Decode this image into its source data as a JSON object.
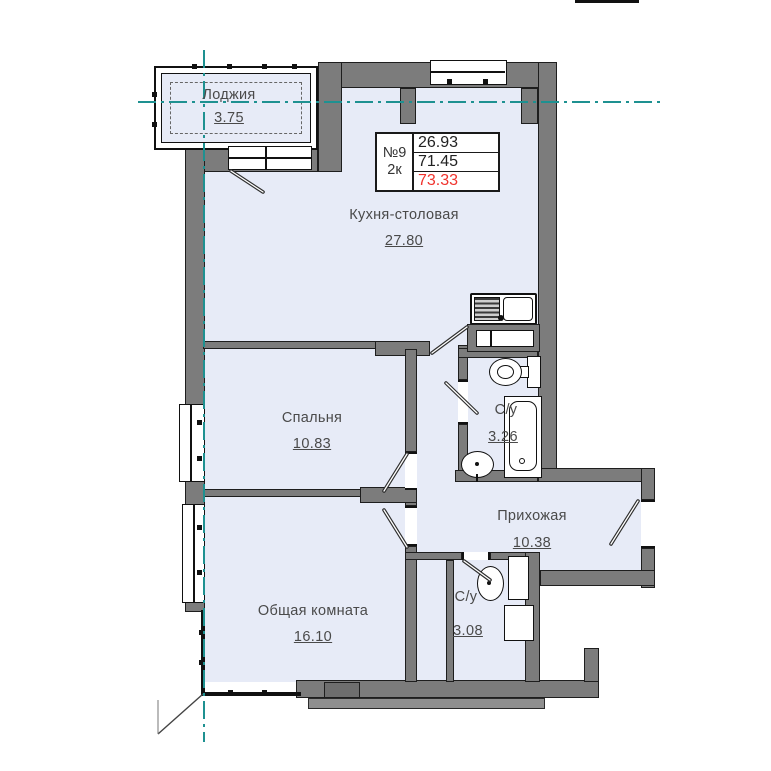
{
  "plan": {
    "unit": {
      "number": "№9",
      "type": "2к",
      "values": [
        "26.93",
        "71.45",
        "73.33"
      ]
    },
    "rooms": [
      {
        "id": "loggia",
        "name": "Лоджия",
        "area": "3.75"
      },
      {
        "id": "kitchen",
        "name": "Кухня-столовая",
        "area": "27.80"
      },
      {
        "id": "bedroom",
        "name": "Спальня",
        "area": "10.83"
      },
      {
        "id": "living",
        "name": "Общая комната",
        "area": "16.10"
      },
      {
        "id": "hallway",
        "name": "Прихожая",
        "area": "10.38"
      },
      {
        "id": "bath1",
        "name": "С/у",
        "area": "3.26"
      },
      {
        "id": "bath2",
        "name": "С/у",
        "area": "3.08"
      }
    ],
    "colors": {
      "wall": "#7c7c7c",
      "room_fill": "#e7ebf7",
      "axis_line": "#1e9191",
      "total_area_highlight": "#f0342e"
    }
  }
}
